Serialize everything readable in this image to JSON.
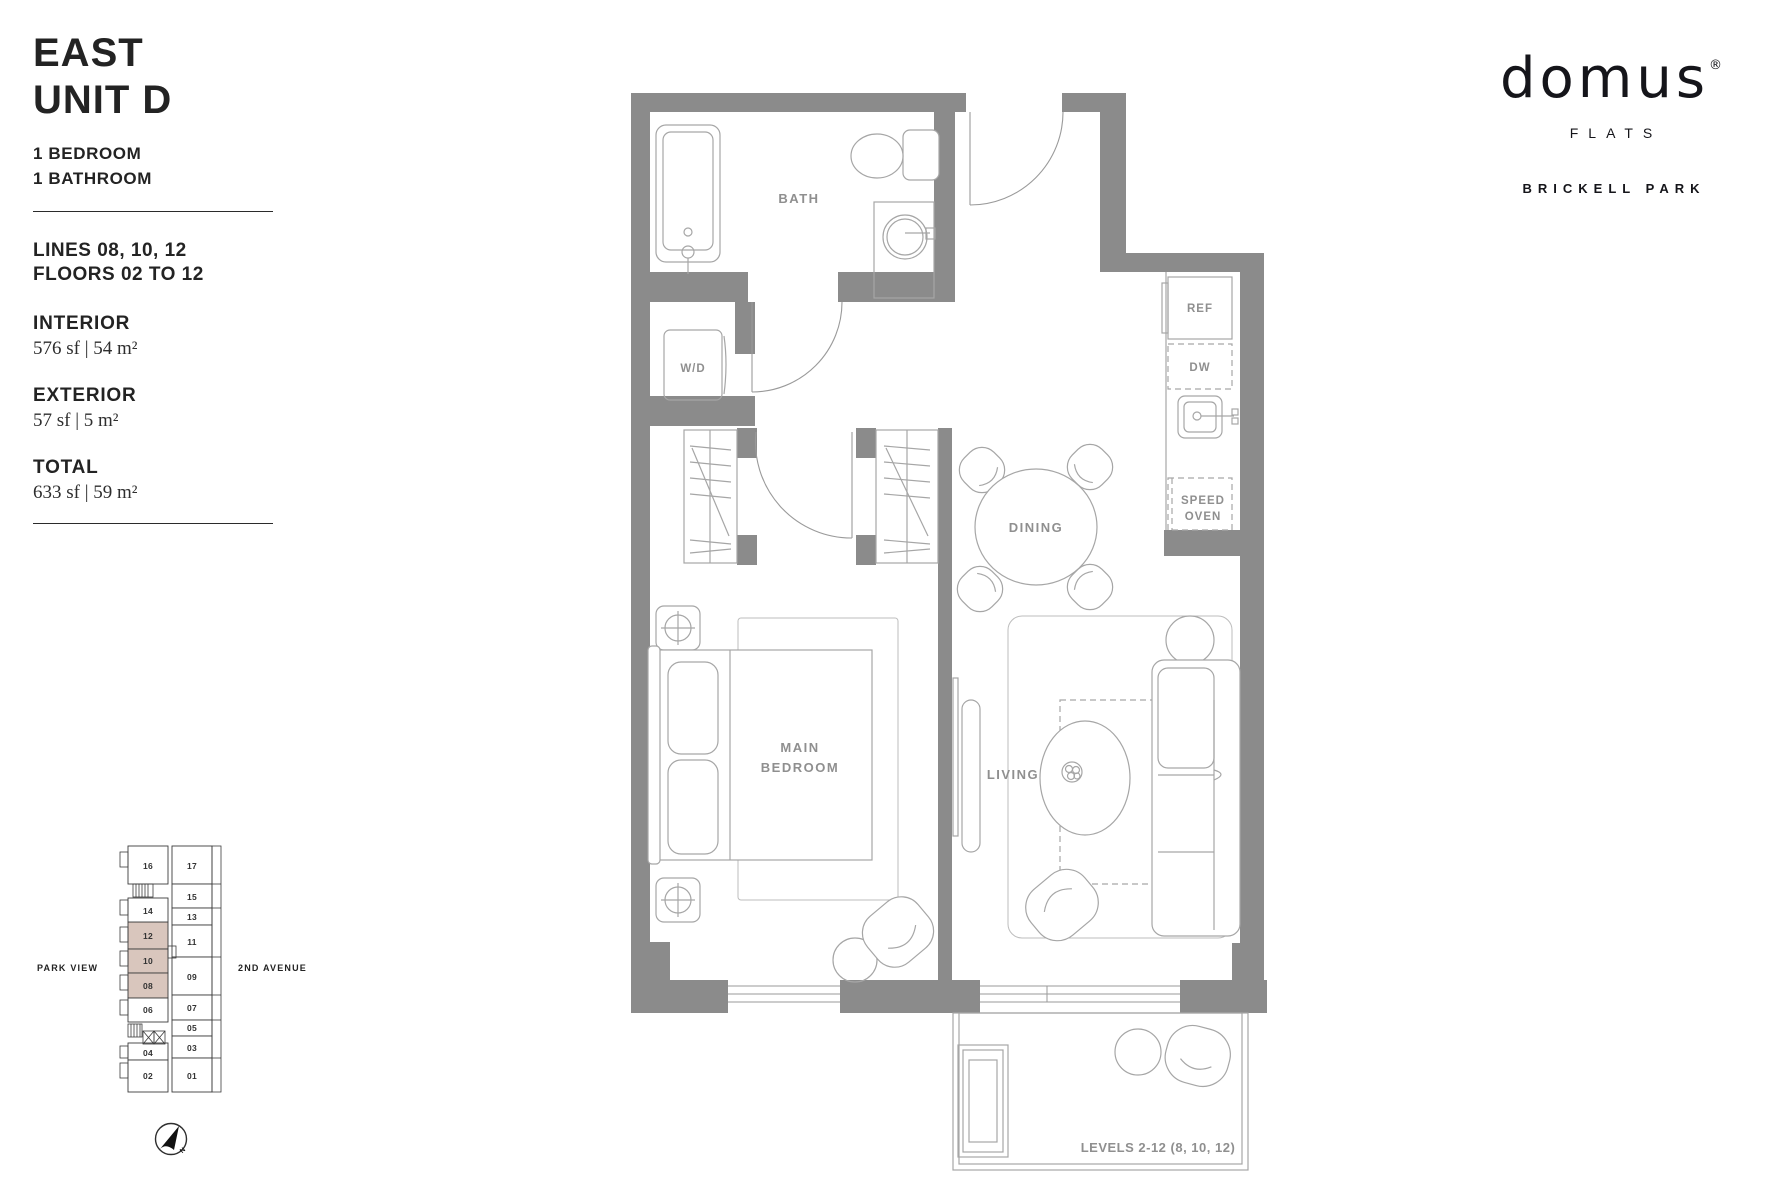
{
  "panel": {
    "title_line1": "EAST",
    "title_line2": "UNIT D",
    "spec1": "1 BEDROOM",
    "spec2": "1 BATHROOM",
    "lines": "LINES 08, 10, 12",
    "floors": "FLOORS 02 TO 12",
    "interior_label": "INTERIOR",
    "interior_value": "576 sf | 54 m²",
    "exterior_label": "EXTERIOR",
    "exterior_value": "57 sf | 5 m²",
    "total_label": "TOTAL",
    "total_value": "633 sf | 59 m²"
  },
  "logo": {
    "brand": "domus",
    "registered": "®",
    "sub": "FLATS",
    "project": "BRICKELL PARK"
  },
  "floorplan": {
    "labels": {
      "bath": "BATH",
      "wd": "W/D",
      "dining": "DINING",
      "main_bedroom_line1": "MAIN",
      "main_bedroom_line2": "BEDROOM",
      "living": "LIVING",
      "ref": "REF",
      "dw": "DW",
      "speed_oven_line1": "SPEED",
      "speed_oven_line2": "OVEN",
      "levels_note": "LEVELS 2-12 (8, 10, 12)"
    },
    "colors": {
      "wall": "#8b8b8b",
      "furniture_line": "#a6a6a6",
      "label": "#8f8f8f"
    }
  },
  "keyplan": {
    "streets": {
      "left": "PARK VIEW",
      "right": "2ND AVENUE"
    },
    "compass": "N",
    "highlight_color": "#d9c6bd",
    "highlighted_units": [
      "08",
      "10",
      "12"
    ],
    "units": [
      {
        "label": "16"
      },
      {
        "label": "17"
      },
      {
        "label": "14"
      },
      {
        "label": "15"
      },
      {
        "label": "13"
      },
      {
        "label": "12"
      },
      {
        "label": "11"
      },
      {
        "label": "10"
      },
      {
        "label": "09"
      },
      {
        "label": "08"
      },
      {
        "label": "06"
      },
      {
        "label": "07"
      },
      {
        "label": "05"
      },
      {
        "label": "04"
      },
      {
        "label": "03"
      },
      {
        "label": "02"
      },
      {
        "label": "01"
      }
    ]
  }
}
